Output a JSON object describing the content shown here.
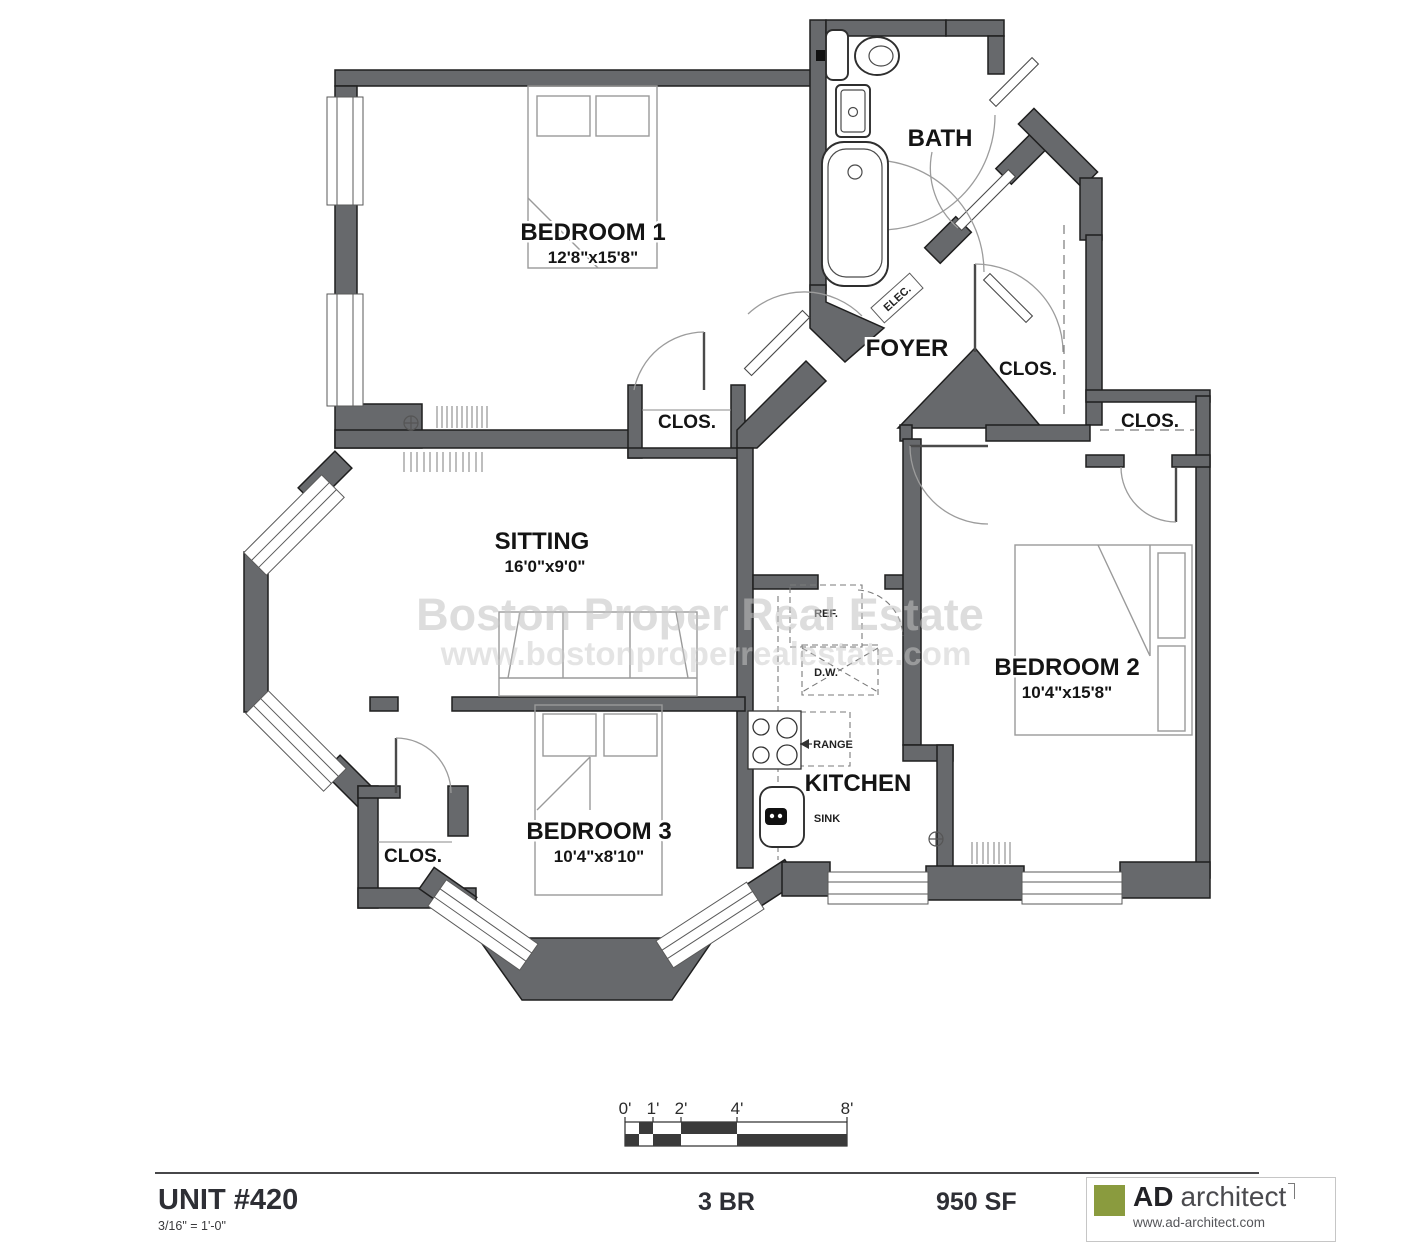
{
  "rooms": {
    "bedroom1": {
      "name": "BEDROOM 1",
      "dims": "12'8\"x15'8\""
    },
    "bedroom2": {
      "name": "BEDROOM 2",
      "dims": "10'4\"x15'8\""
    },
    "bedroom3": {
      "name": "BEDROOM 3",
      "dims": "10'4\"x8'10\""
    },
    "sitting": {
      "name": "SITTING",
      "dims": "16'0\"x9'0\""
    },
    "bath": {
      "name": "BATH"
    },
    "foyer": {
      "name": "FOYER"
    },
    "kitchen": {
      "name": "KITCHEN"
    },
    "closet_label": "CLOS."
  },
  "fixtures": {
    "sink": "SINK",
    "range": "RANGE",
    "dishwasher": "D.W.",
    "refrigerator": "REF.",
    "electrical": "ELEC."
  },
  "watermark": {
    "line1": "Boston Proper Real Estate",
    "line2": "www.bostonproperrealestate.com"
  },
  "scale_bar": {
    "tick0": "0'",
    "tick1": "1'",
    "tick2": "2'",
    "tick4": "4'",
    "tick8": "8'"
  },
  "footer": {
    "unit": "UNIT #420",
    "scale_note": "3/16\" = 1'-0\"",
    "bedrooms": "3 BR",
    "area": "950 SF"
  },
  "logo": {
    "ad": "AD",
    "architect": "architect",
    "website": "www.ad-architect.com"
  },
  "colors": {
    "wall": "#67696c",
    "logo_green": "#8a9b3e",
    "scale_block": "#3a3a3a"
  }
}
